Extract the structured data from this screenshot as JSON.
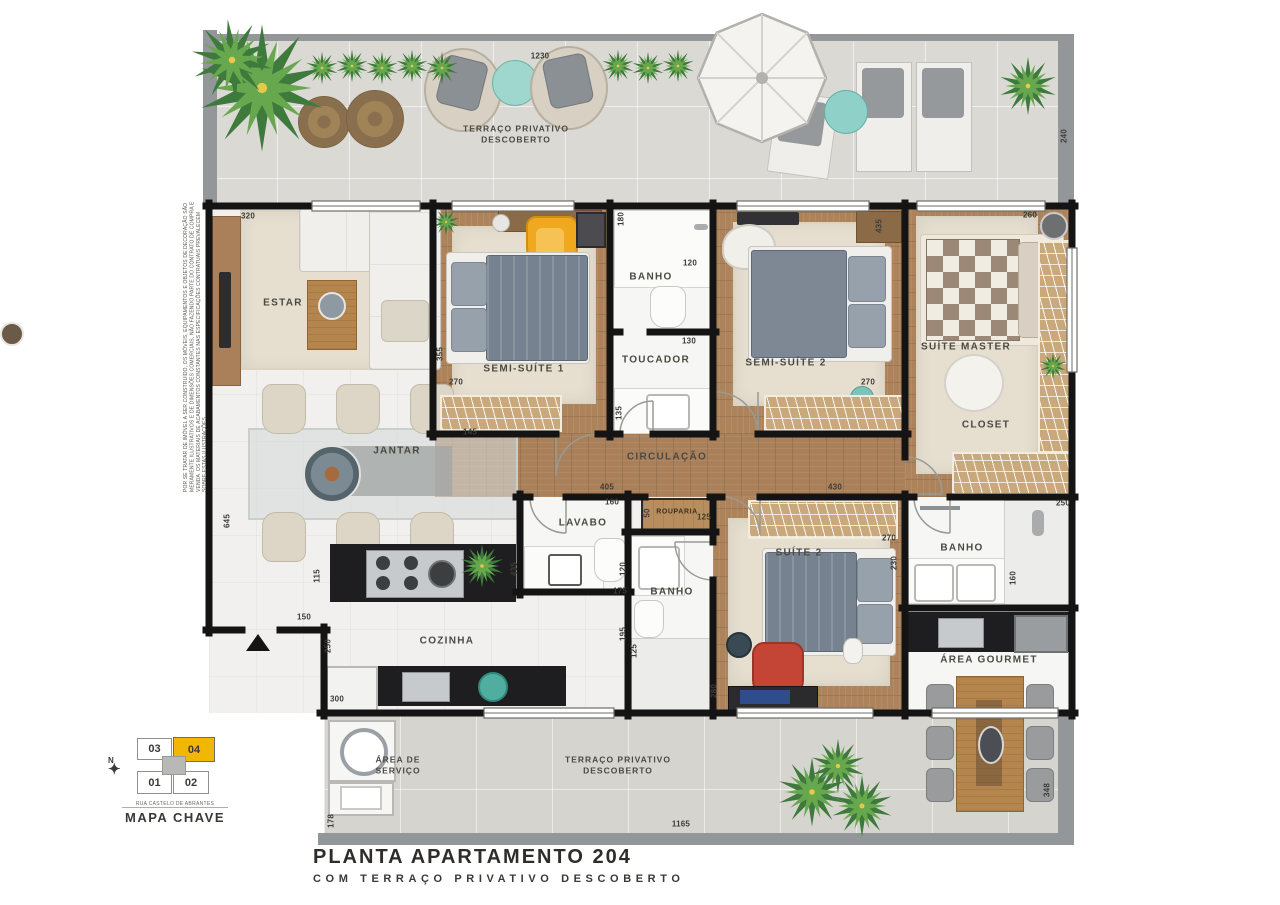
{
  "plan": {
    "title_line1": "PLANTA APARTAMENTO 204",
    "title_line2": "COM TERRAÇO PRIVATIVO DESCOBERTO",
    "disclaimer": "POR SE TRATAR DE IMÓVEL A SER CONSTRUÍDO, OS MÓVEIS, EQUIPAMENTOS E OBJETOS DE DECORAÇÃO SÃO MERAMENTE ILUSTRATIVOS E DE DIMENSÕES COMERCIAIS, NÃO FAZENDO PARTE DO CONTRATO DE COMPRA E VENDA. OS MATERIAIS DE ACABAMENTOS CONSTANTES NAS ESPECIFICAÇÕES CONTRATUAIS PREVALECEM SOBRE ESTAS ILUSTRAÇÕES."
  },
  "rooms": {
    "terraco_top_l1": "TERRAÇO PRIVATIVO",
    "terraco_top_l2": "DESCOBERTO",
    "estar": "ESTAR",
    "jantar": "JANTAR",
    "semi_suite1": "SEMI-SUÍTE 1",
    "banho1": "BANHO",
    "toucador": "TOUCADOR",
    "semi_suite2": "SEMI-SUÍTE 2",
    "suite_master": "SUÍTE MASTER",
    "closet": "CLOSET",
    "circulacao": "CIRCULAÇÃO",
    "lavabo": "LAVABO",
    "rouparia": "ROUPARIA",
    "banho2": "BANHO",
    "suite2": "SUÍTE 2",
    "banho3": "BANHO",
    "area_gourmet": "ÁREA GOURMET",
    "cozinha": "COZINHA",
    "area_servico_l1": "ÁREA DE",
    "area_servico_l2": "SERVIÇO",
    "terraco_bottom_l1": "TERRAÇO PRIVATIVO",
    "terraco_bottom_l2": "DESCOBERTO"
  },
  "key_map": {
    "title": "MAPA CHAVE",
    "street": "RUA CASTELO DE ABRANTES",
    "north": "N",
    "unit_03": "03",
    "unit_04": "04",
    "unit_01": "01",
    "unit_02": "02",
    "highlighted_unit": "04",
    "highlight_color": "#f2b705"
  },
  "dimensions_cm": [
    {
      "v": "1230",
      "x": 540,
      "y": 56,
      "r": 0
    },
    {
      "v": "240",
      "x": 1064,
      "y": 136,
      "r": 1
    },
    {
      "v": "320",
      "x": 248,
      "y": 216,
      "r": 0
    },
    {
      "v": "355",
      "x": 440,
      "y": 354,
      "r": 1
    },
    {
      "v": "270",
      "x": 456,
      "y": 382,
      "r": 0
    },
    {
      "v": "145",
      "x": 470,
      "y": 432,
      "r": 0
    },
    {
      "v": "180",
      "x": 621,
      "y": 219,
      "r": 1
    },
    {
      "v": "120",
      "x": 690,
      "y": 263,
      "r": 0
    },
    {
      "v": "130",
      "x": 689,
      "y": 341,
      "r": 0
    },
    {
      "v": "135",
      "x": 619,
      "y": 413,
      "r": 1
    },
    {
      "v": "435",
      "x": 879,
      "y": 226,
      "r": 1
    },
    {
      "v": "270",
      "x": 868,
      "y": 382,
      "r": 0
    },
    {
      "v": "260",
      "x": 1030,
      "y": 215,
      "r": 0
    },
    {
      "v": "405",
      "x": 607,
      "y": 487,
      "r": 0
    },
    {
      "v": "160",
      "x": 612,
      "y": 502,
      "r": 0
    },
    {
      "v": "50",
      "x": 647,
      "y": 513,
      "r": 1
    },
    {
      "v": "125",
      "x": 704,
      "y": 517,
      "r": 0
    },
    {
      "v": "430",
      "x": 835,
      "y": 487,
      "r": 0
    },
    {
      "v": "270",
      "x": 889,
      "y": 538,
      "r": 0
    },
    {
      "v": "230",
      "x": 894,
      "y": 563,
      "r": 1
    },
    {
      "v": "250",
      "x": 1063,
      "y": 503,
      "r": 0
    },
    {
      "v": "160",
      "x": 1013,
      "y": 578,
      "r": 1
    },
    {
      "v": "435",
      "x": 514,
      "y": 569,
      "r": 1
    },
    {
      "v": "120",
      "x": 623,
      "y": 569,
      "r": 1
    },
    {
      "v": "175",
      "x": 620,
      "y": 591,
      "r": 0
    },
    {
      "v": "195",
      "x": 623,
      "y": 634,
      "r": 1
    },
    {
      "v": "125",
      "x": 634,
      "y": 651,
      "r": 1
    },
    {
      "v": "280",
      "x": 714,
      "y": 691,
      "r": 1
    },
    {
      "v": "115",
      "x": 317,
      "y": 576,
      "r": 1
    },
    {
      "v": "150",
      "x": 304,
      "y": 617,
      "r": 0
    },
    {
      "v": "250",
      "x": 328,
      "y": 646,
      "r": 1
    },
    {
      "v": "300",
      "x": 337,
      "y": 699,
      "r": 0
    },
    {
      "v": "178",
      "x": 331,
      "y": 821,
      "r": 1
    },
    {
      "v": "645",
      "x": 227,
      "y": 521,
      "r": 1
    },
    {
      "v": "1165",
      "x": 681,
      "y": 824,
      "r": 0
    },
    {
      "v": "348",
      "x": 1047,
      "y": 790,
      "r": 1
    }
  ]
}
